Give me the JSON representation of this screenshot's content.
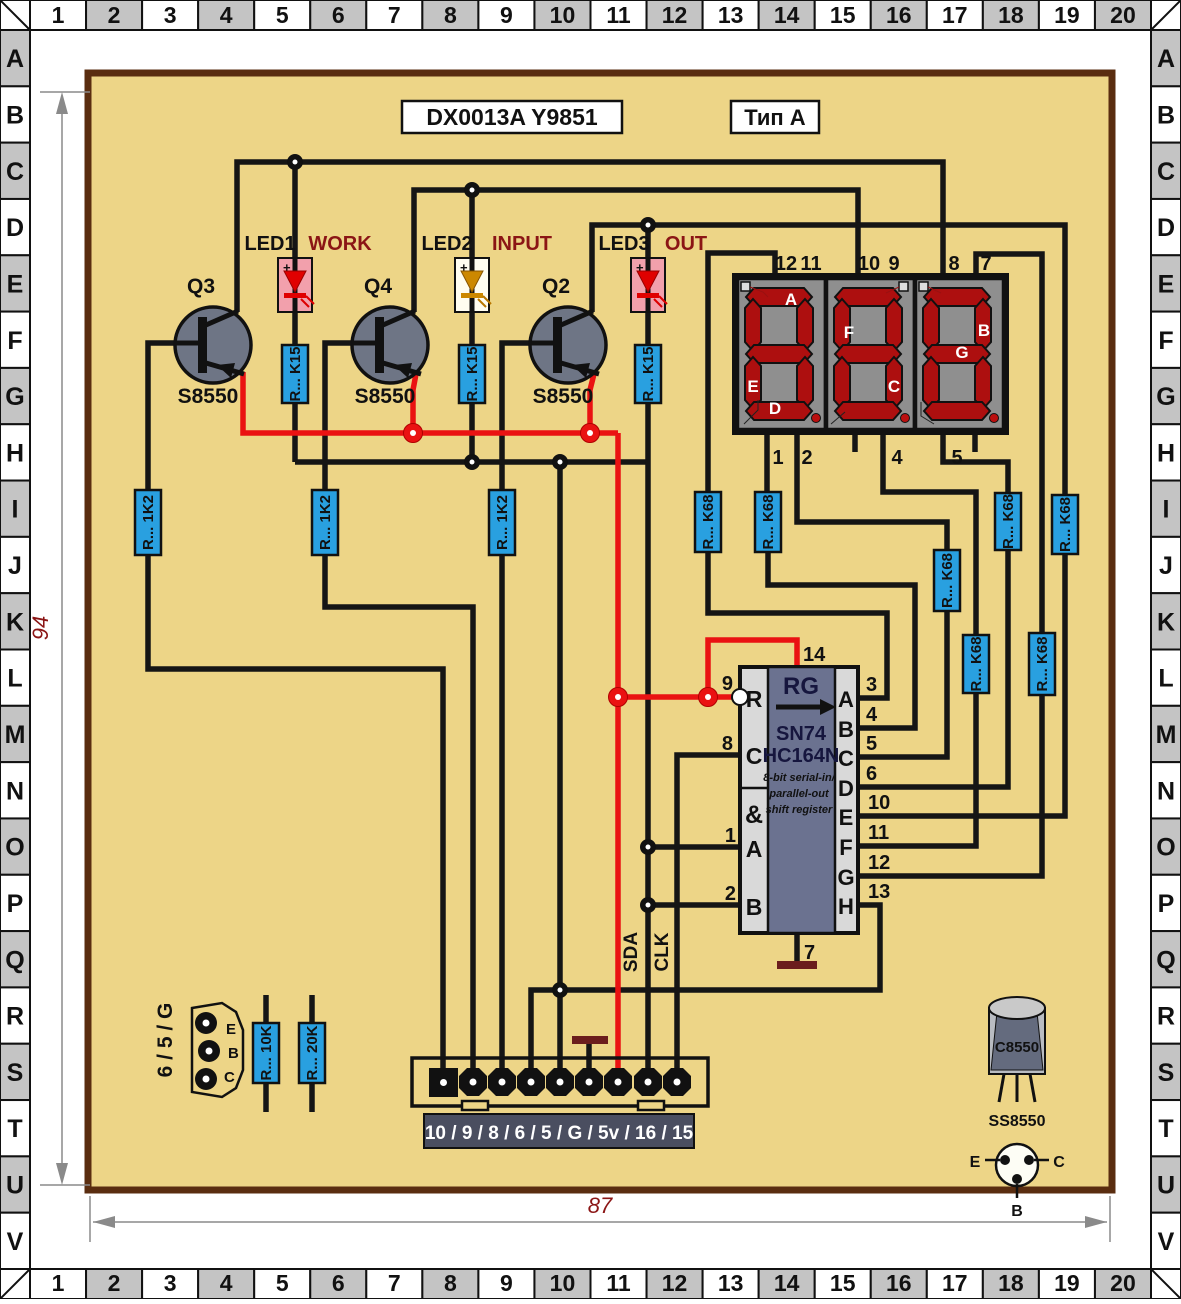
{
  "frame": {
    "columns": [
      "1",
      "2",
      "3",
      "4",
      "5",
      "6",
      "7",
      "8",
      "9",
      "10",
      "11",
      "12",
      "13",
      "14",
      "15",
      "16",
      "17",
      "18",
      "19",
      "20"
    ],
    "rows": [
      "A",
      "B",
      "C",
      "D",
      "E",
      "F",
      "G",
      "H",
      "I",
      "J",
      "K",
      "L",
      "M",
      "N",
      "O",
      "P",
      "Q",
      "R",
      "S",
      "T",
      "U",
      "V"
    ]
  },
  "header": {
    "part_number": "DX0013A  Y9851",
    "type_label": "Тип A"
  },
  "dimensions": {
    "height": "94",
    "width": "87"
  },
  "transistors": [
    {
      "ref": "Q3",
      "part": "S8550"
    },
    {
      "ref": "Q4",
      "part": "S8550"
    },
    {
      "ref": "Q2",
      "part": "S8550"
    }
  ],
  "leds": [
    {
      "ref": "LED1",
      "function": "WORK"
    },
    {
      "ref": "LED2",
      "function": "INPUT"
    },
    {
      "ref": "LED3",
      "function": "OUT"
    }
  ],
  "resistor_labels": {
    "k15": "R... K15",
    "r1k2": "R... 1K2",
    "k68": "R... K68",
    "r10k": "R... 10K",
    "r20k": "R... 20K"
  },
  "display": {
    "top_pins": [
      "12",
      "11",
      "10",
      "9",
      "8",
      "7"
    ],
    "bottom_pins": [
      "1",
      "2",
      "4",
      "5"
    ],
    "segment_letters": {
      "digit1": [
        "A",
        "E",
        "D"
      ],
      "digit2": [
        "F",
        "C"
      ],
      "digit3": [
        "B",
        "G"
      ]
    }
  },
  "ic": {
    "reg_symbol": "RG",
    "part_line1": "SN74",
    "part_line2": "HC164N",
    "desc_line1": "8-bit serial-in/",
    "desc_line2": "parallel-out",
    "desc_line3": "shift register",
    "top_pin": "14",
    "bottom_pin": "7",
    "left_pins": [
      {
        "num": "9",
        "name": "R"
      },
      {
        "num": "8",
        "name": "C"
      },
      {
        "num": "",
        "name": "&"
      },
      {
        "num": "1",
        "name": "A"
      },
      {
        "num": "2",
        "name": "B"
      }
    ],
    "right_pins": [
      {
        "num": "3",
        "name": "A"
      },
      {
        "num": "4",
        "name": "B"
      },
      {
        "num": "5",
        "name": "C"
      },
      {
        "num": "6",
        "name": "D"
      },
      {
        "num": "10",
        "name": "E"
      },
      {
        "num": "11",
        "name": "F"
      },
      {
        "num": "12",
        "name": "G"
      },
      {
        "num": "13",
        "name": "H"
      }
    ]
  },
  "signals": {
    "sda": "SDA",
    "clk": "CLK"
  },
  "connector": {
    "pin_labels": "10 / 9 / 8 / 6 / 5 / G / 5v / 16 / 15"
  },
  "aux_connector": {
    "label": "6 / 5 / G",
    "pins": [
      "E",
      "B",
      "C"
    ]
  },
  "package": {
    "body_marking": "C8550",
    "part_name": "SS8550",
    "pins": {
      "e": "E",
      "b": "B",
      "c": "C"
    }
  },
  "colors": {
    "board": "#EDD587",
    "board_border": "#5A2D10",
    "resistor_blue": "#29A0E0",
    "wire_red": "#EA1212",
    "label_dark_red": "#8B1515",
    "display_bg": "#8F8F8F",
    "segment_red": "#AD0F0F",
    "ic_body": "#6B7290",
    "grid_gray": "#C4C4C4",
    "led_pink": "#F2A0AC",
    "led_amber": "#CC8800",
    "ground_maroon": "#6B1D1D"
  }
}
